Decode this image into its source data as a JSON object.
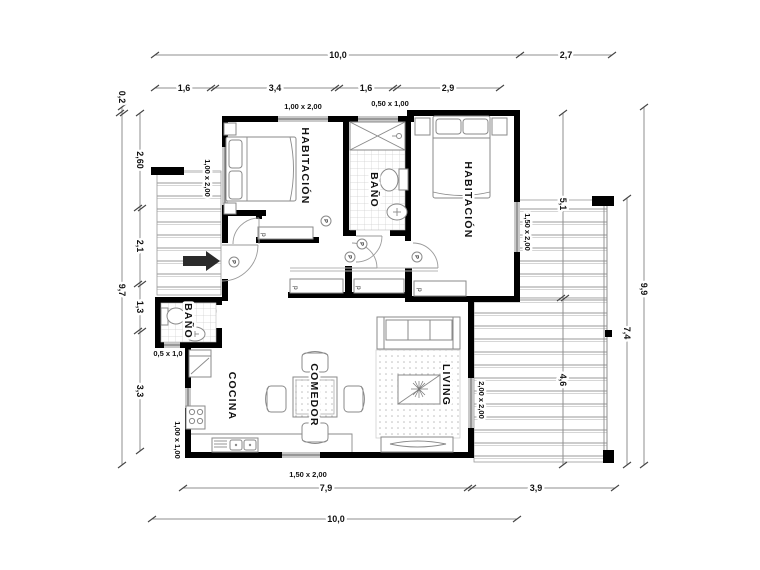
{
  "rooms": {
    "bedroom1": "HABITACIÓN",
    "bedroom2": "HABITACIÓN",
    "bathroom1": "BAÑO",
    "bathroom2": "BAÑO",
    "kitchen": "COCINA",
    "dining": "COMEDOR",
    "living": "LIVING"
  },
  "windows": {
    "bed1_top": "1,00 x 2,00",
    "bath1_top": "0,50 x 1,00",
    "bed1_left": "1,00 x 2,00",
    "bed2_right": "1,50 x 2,00",
    "bath2": "0,5 x 1,0",
    "living_right": "2,00 x 2,00",
    "kitchen_left": "1,00 x 1,00",
    "kitchen_bottom": "1,50 x 2,00"
  },
  "dims": {
    "top_total": "10,0",
    "top_right": "2,7",
    "top_seg1": "1,6",
    "top_seg2": "3,4",
    "top_seg3": "1,6",
    "top_seg4": "2,9",
    "left_offset": "0,2",
    "left_total": "9,7",
    "left_seg1": "2,60",
    "left_seg2": "2,1",
    "left_seg3": "1,3",
    "left_seg4": "3,3",
    "right_seg1": "5,1",
    "right_seg2": "4,6",
    "right_deck": "7,4",
    "right_total": "9,9",
    "bottom_seg1": "7,9",
    "bottom_seg2": "3,9",
    "bottom_total": "10,0"
  },
  "tags": {
    "door": "P",
    "closet": "p"
  },
  "colors": {
    "wall": "#000000",
    "window": "#c9c9c9",
    "line": "#8a8a8a"
  }
}
